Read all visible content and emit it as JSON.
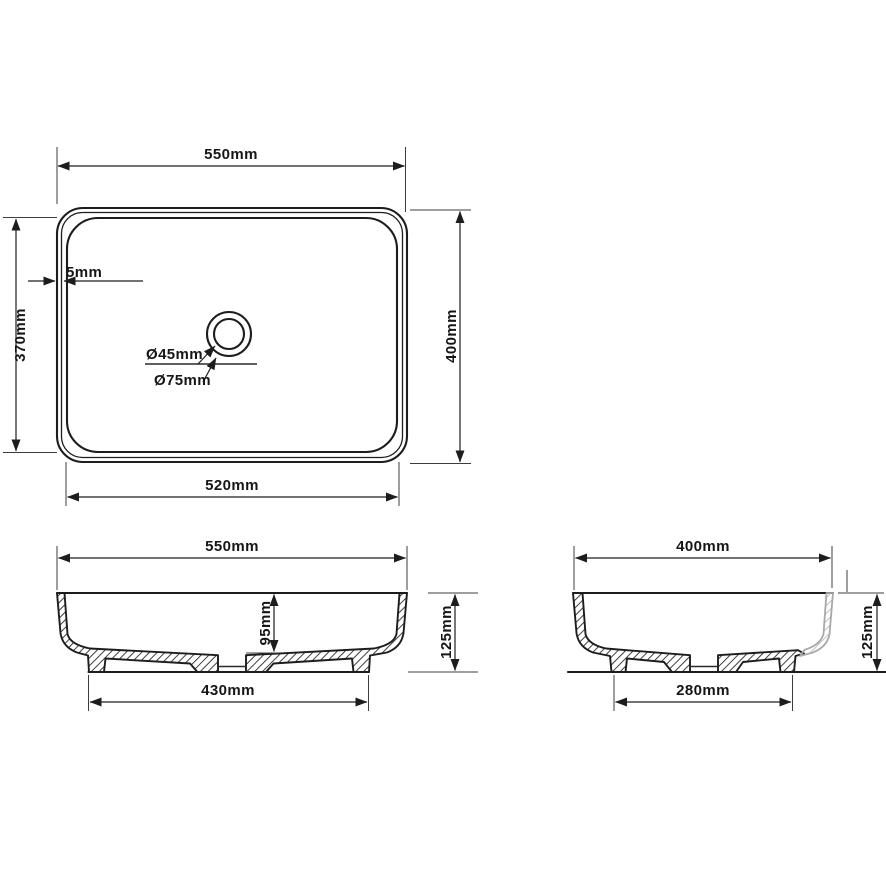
{
  "drawing_type": "basin technical drawing, three orthographic views",
  "views": {
    "top": {
      "outer_width": "550mm",
      "outer_height": "400mm",
      "inner_width": "520mm",
      "inner_height": "370mm",
      "wall_thickness": "5mm",
      "drain_hole_diameter": "Ø45mm",
      "drain_recess_diameter": "Ø75mm"
    },
    "front_section": {
      "overall_width": "550mm",
      "bowl_depth": "95mm",
      "overall_height": "125mm",
      "base_width": "430mm"
    },
    "side_section": {
      "overall_width": "400mm",
      "overall_height": "125mm",
      "base_width": "280mm"
    }
  },
  "colors": {
    "line": "#1d1d1d",
    "phantom_line": "#a9a9a9",
    "background": "#ffffff"
  }
}
